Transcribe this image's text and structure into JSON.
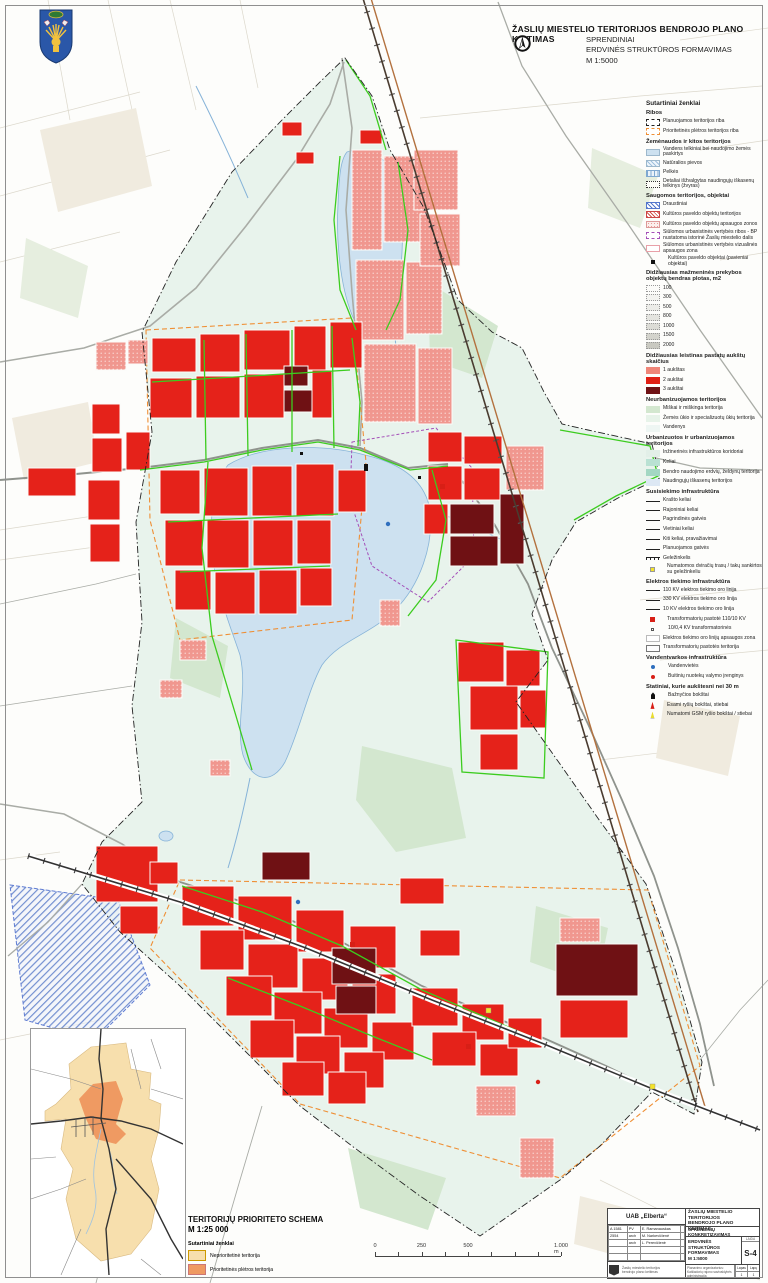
{
  "header": {
    "title": "ŽASLIŲ MIESTELIO TERITORIJOS BENDROJO PLANO KEITIMAS",
    "subtitle_line1": "SPRENDINIAI",
    "subtitle_line2": "ERDVINĖS STRUKTŪROS FORMAVIMAS",
    "subtitle_line3": "M 1:5000"
  },
  "legend": {
    "title": "Sutartiniai ženklai",
    "sections": [
      {
        "title": "Ribos",
        "items": [
          {
            "sw": "dash-black",
            "label": "Planuojamos teritorijos riba"
          },
          {
            "sw": "dash-orange",
            "label": "Prioritetinės plėtros teritorijos riba"
          }
        ]
      },
      {
        "title": "Žemėnaudos ir kitos teritorijos",
        "items": [
          {
            "sw": "fill-water",
            "label": "Vandens telkiniai bei naudojimo žemės paskirtys"
          },
          {
            "sw": "hatch-blue-lt",
            "label": "Natūralios pievos"
          },
          {
            "sw": "stripe-blue",
            "label": "Pelkės"
          },
          {
            "sw": "dot-outline",
            "label": "Detaliai išžvalgytas naudingųjų iškasenų telkinys (žvyras)"
          }
        ]
      },
      {
        "title": "Saugomos teritorijos, objektai",
        "items": [
          {
            "sw": "hatch-blue",
            "label": "Draustiniai"
          },
          {
            "sw": "hatch-red",
            "label": "Kultūros paveldo objektų teritorijos"
          },
          {
            "sw": "dots-pink",
            "label": "Kultūros paveldo objektų apsaugos zonos"
          },
          {
            "sw": "dash-purple",
            "label": "Siūlomos urbanistinės vertybės ribos - BP nustatoma istorinė Žaslių miestelio dalis"
          },
          {
            "sw": "outline-pink",
            "label": "Siūlomos urbanistinės vertybės vizualinės apsaugos zona"
          },
          {
            "sw": "sq-black",
            "label": "Kultūros paveldo objektai (pavieniai objektai)"
          }
        ]
      },
      {
        "title": "Didžiausias mažmeninės prekybos objektų bendras plotas, m2",
        "items": [
          {
            "sw": "m2 g1",
            "label": "100"
          },
          {
            "sw": "m2 g2",
            "label": "300"
          },
          {
            "sw": "m2 g3",
            "label": "500"
          },
          {
            "sw": "m2 g4",
            "label": "800"
          },
          {
            "sw": "m2 g5",
            "label": "1000"
          },
          {
            "sw": "m2 g6",
            "label": "1500"
          },
          {
            "sw": "m2 g7",
            "label": "2000"
          }
        ]
      },
      {
        "title": "Didžiausias leistinas pastatų aukštų skaičius",
        "items": [
          {
            "sw": "red-1",
            "label": "1 aukštas"
          },
          {
            "sw": "red-2",
            "label": "2 aukštai"
          },
          {
            "sw": "red-3",
            "label": "3 aukštai"
          }
        ]
      },
      {
        "title": "Neurbanizuojamos teritorijos",
        "items": [
          {
            "sw": "fill-forest",
            "label": "Miškai ir miškinga teritorija"
          },
          {
            "sw": "fill-agri",
            "label": "Žemės ūkio ir specializuotų ūkių teritorija"
          },
          {
            "sw": "fill-waterpale",
            "label": "Vandenys"
          }
        ]
      },
      {
        "title": "Urbanizuotos ir urbanizuojamos teritorijos",
        "items": [
          {
            "sw": "fill-infra",
            "label": "Inžinerinės infrastruktūros koridoriai"
          },
          {
            "sw": "fill-roads",
            "label": "Keliai"
          },
          {
            "sw": "fill-greens",
            "label": "Bendro naudojimo erdvių, želdynų teritorija"
          },
          {
            "sw": "fill-minerals",
            "label": "Naudingųjų iškasenų teritorijos"
          }
        ]
      },
      {
        "title": "Susisiekimo infrastruktūra",
        "items": [
          {
            "sw": "line line-thick",
            "label": "Krašto keliai"
          },
          {
            "sw": "line line-med",
            "label": "Rajoniniai keliai"
          },
          {
            "sw": "line line-main",
            "label": "Pagrindinės gatvės"
          },
          {
            "sw": "line line-local",
            "label": "Vietiniai keliai"
          },
          {
            "sw": "line line-other",
            "label": "Kiti keliai, pravažiavimai"
          },
          {
            "sw": "line line-planned",
            "label": "Planuojamos gatvės"
          },
          {
            "sw": "line-rail",
            "label": "Geležinkelis"
          },
          {
            "sw": "sq-yellow",
            "label": "Numatomos dviračių trasų / takų sankirtos su geležinkeliu"
          }
        ]
      },
      {
        "title": "Elektros tiekimo infrastruktūra",
        "items": [
          {
            "sw": "line line-110",
            "label": "110 KV elektros tiekimo oro linija"
          },
          {
            "sw": "line line-330",
            "label": "330 KV elektros tiekimo oro linija"
          },
          {
            "sw": "line line-10",
            "label": "10 KV elektros tiekimo oro linija"
          },
          {
            "sw": "sq-red",
            "label": "Transformatorių pastotė 110/10 KV"
          },
          {
            "sw": "sq-small",
            "label": "10/0,4 KV transformatorinės"
          },
          {
            "sw": "zone-blank",
            "label": "Elektros tiekimo oro linijų apsaugos zona"
          },
          {
            "sw": "zone-outline",
            "label": "Transformatorių pastotės teritorija"
          }
        ]
      },
      {
        "title": "Vandentvarkos infrastruktūra",
        "items": [
          {
            "sw": "dot-blue",
            "label": "Vandenvietės"
          },
          {
            "sw": "dot-red",
            "label": "Buitinių nuotekų valymo įrenginys"
          }
        ]
      },
      {
        "title": "Statiniai, kurie aukštesni nei 30 m",
        "items": [
          {
            "sw": "ic-church",
            "label": "Bažnyčios bokštai"
          },
          {
            "sw": "ic-tower-red",
            "label": "Esami ryšių bokštai, stiebai"
          },
          {
            "sw": "ic-tower-yellow",
            "label": "Numatomi GSM ryšio bokštai / stiebai"
          }
        ]
      }
    ]
  },
  "map": {
    "lake_label": "Žaslių ež."
  },
  "inset": {
    "title": "TERITORIJŲ PRIORITETO SCHEMA",
    "scale": "M 1:25 000",
    "legend_title": "Sutartiniai ženklai",
    "items": [
      {
        "sw": "sw-tan",
        "label": "Neprioritetinė teritorija"
      },
      {
        "sw": "sw-org",
        "label": "Prioritetinės plėtros teritorija"
      }
    ]
  },
  "scalebar": {
    "labels": [
      "0",
      "250",
      "500",
      "1.000 m"
    ],
    "positions": [
      0,
      25,
      50,
      100
    ]
  },
  "titleblock": {
    "company": "UAB „Elberta“",
    "staff": [
      [
        "A 1581",
        "PV",
        "E. Ramanauskas",
        ""
      ],
      [
        "2554",
        "arch",
        "M. Narkevičienė",
        ""
      ],
      [
        "",
        "arch",
        "L. Perevičienė",
        ""
      ],
      [
        "",
        "",
        "",
        ""
      ],
      [
        "",
        "",
        "",
        ""
      ]
    ],
    "project_line1": "ŽASLIŲ MIESTELIO TERITORIJOS",
    "project_line2": "BENDROJO PLANO KEITIMAS",
    "stage": "SPRENDINIŲ KONKRETIZAVIMAS",
    "drawing_line1": "ERDVINĖS STRUKTŪROS",
    "drawing_line2": "FORMAVIMAS",
    "drawing_line3": "M 1:5000",
    "sheet_caption": "LAIDA",
    "sheet": "S-4",
    "organizer_line1": "Planavimo organizatorius:",
    "organizer_line2": "Kaišiadorių rajono savivaldybės administracija",
    "footer_left1": "Žaslių miestelio teritorijos",
    "footer_left2": "bendrojo plano keitimas",
    "pages": [
      "Lapas",
      "Lapų",
      "1",
      "1"
    ]
  },
  "colors": {
    "floors1": "#ef8578",
    "floors2": "#e01f14",
    "floors3": "#6f1114",
    "urban_bg": "#e8f3ec",
    "water": "#cde1f0",
    "green_line": "#3ccc1f",
    "priority_orange": "#ef8f35",
    "inset_tan": "#f7dfad",
    "inset_orange": "#ef9a62"
  }
}
